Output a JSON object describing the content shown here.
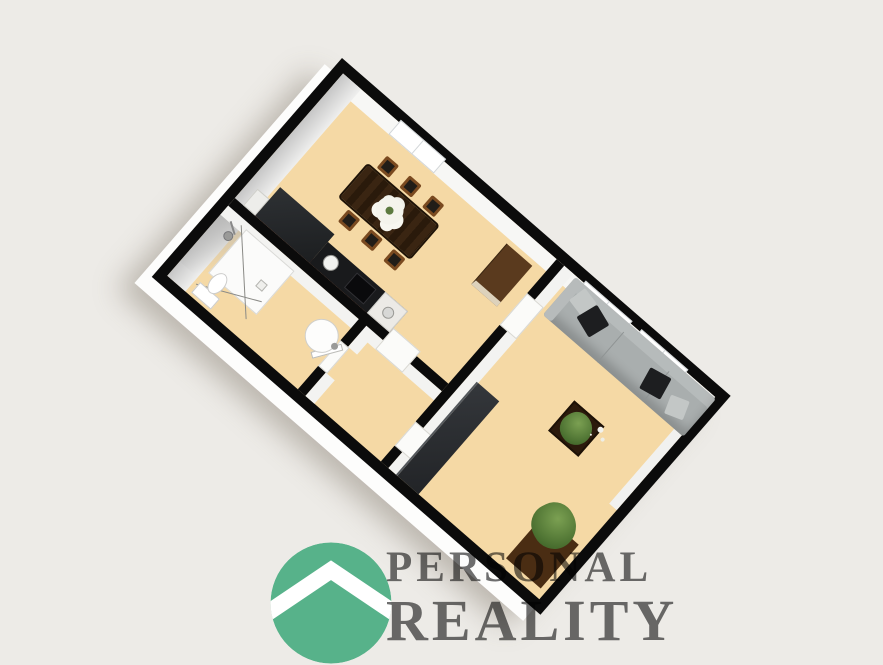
{
  "brand": {
    "name_line1": "PERSONAL",
    "name_line2": "REALITY",
    "logo_color": "#57b28a",
    "text_color": "#6f6f6f"
  },
  "colors": {
    "background": "#edebe7",
    "floor_tan": "#f5d9a5",
    "walls_black": "#0b0b0b",
    "inner_wall_face": "#f3f3f1",
    "outer_slab_white": "#fdfdfc",
    "sofa_gray": "#a9aeae",
    "pillow_black": "#1d1e20",
    "table_wood_dark": "#32200f",
    "chair_wood": "#7a4a20",
    "sideboard_brown": "#5a3a1e",
    "kitchen_counter": "#191a1c",
    "backsplash_red": "#7e3a2b",
    "plant_green": "#4c7030",
    "wardrobe_dark": "#2b2e31"
  },
  "floorplan": {
    "view": "isometric-3d-render",
    "rotation_deg": 41,
    "rooms": [
      {
        "name": "kitchen-dining-room",
        "furniture": [
          "dining-table",
          "dining-chairs-x6",
          "flower-centerpiece",
          "kitchen-counter",
          "kitchen-tall-unit",
          "kitchen-sink",
          "cooktop",
          "kettle-cabinet",
          "backsplash-strip",
          "sideboard",
          "window"
        ]
      },
      {
        "name": "bathroom",
        "furniture": [
          "shower-tray",
          "shower-glass-outline",
          "shower-head",
          "toilet",
          "round-washbasin"
        ]
      },
      {
        "name": "hallway",
        "furniture": [
          "door-to-kitchen",
          "door-to-bathroom",
          "door-to-living-room"
        ]
      },
      {
        "name": "living-room",
        "furniture": [
          "sofa",
          "black-pillows-x2",
          "gray-pillows-x2",
          "coffee-table",
          "coffee-table-plant",
          "wardrobe",
          "floor-plant",
          "windows-x2",
          "door-to-dining-room"
        ]
      }
    ]
  }
}
